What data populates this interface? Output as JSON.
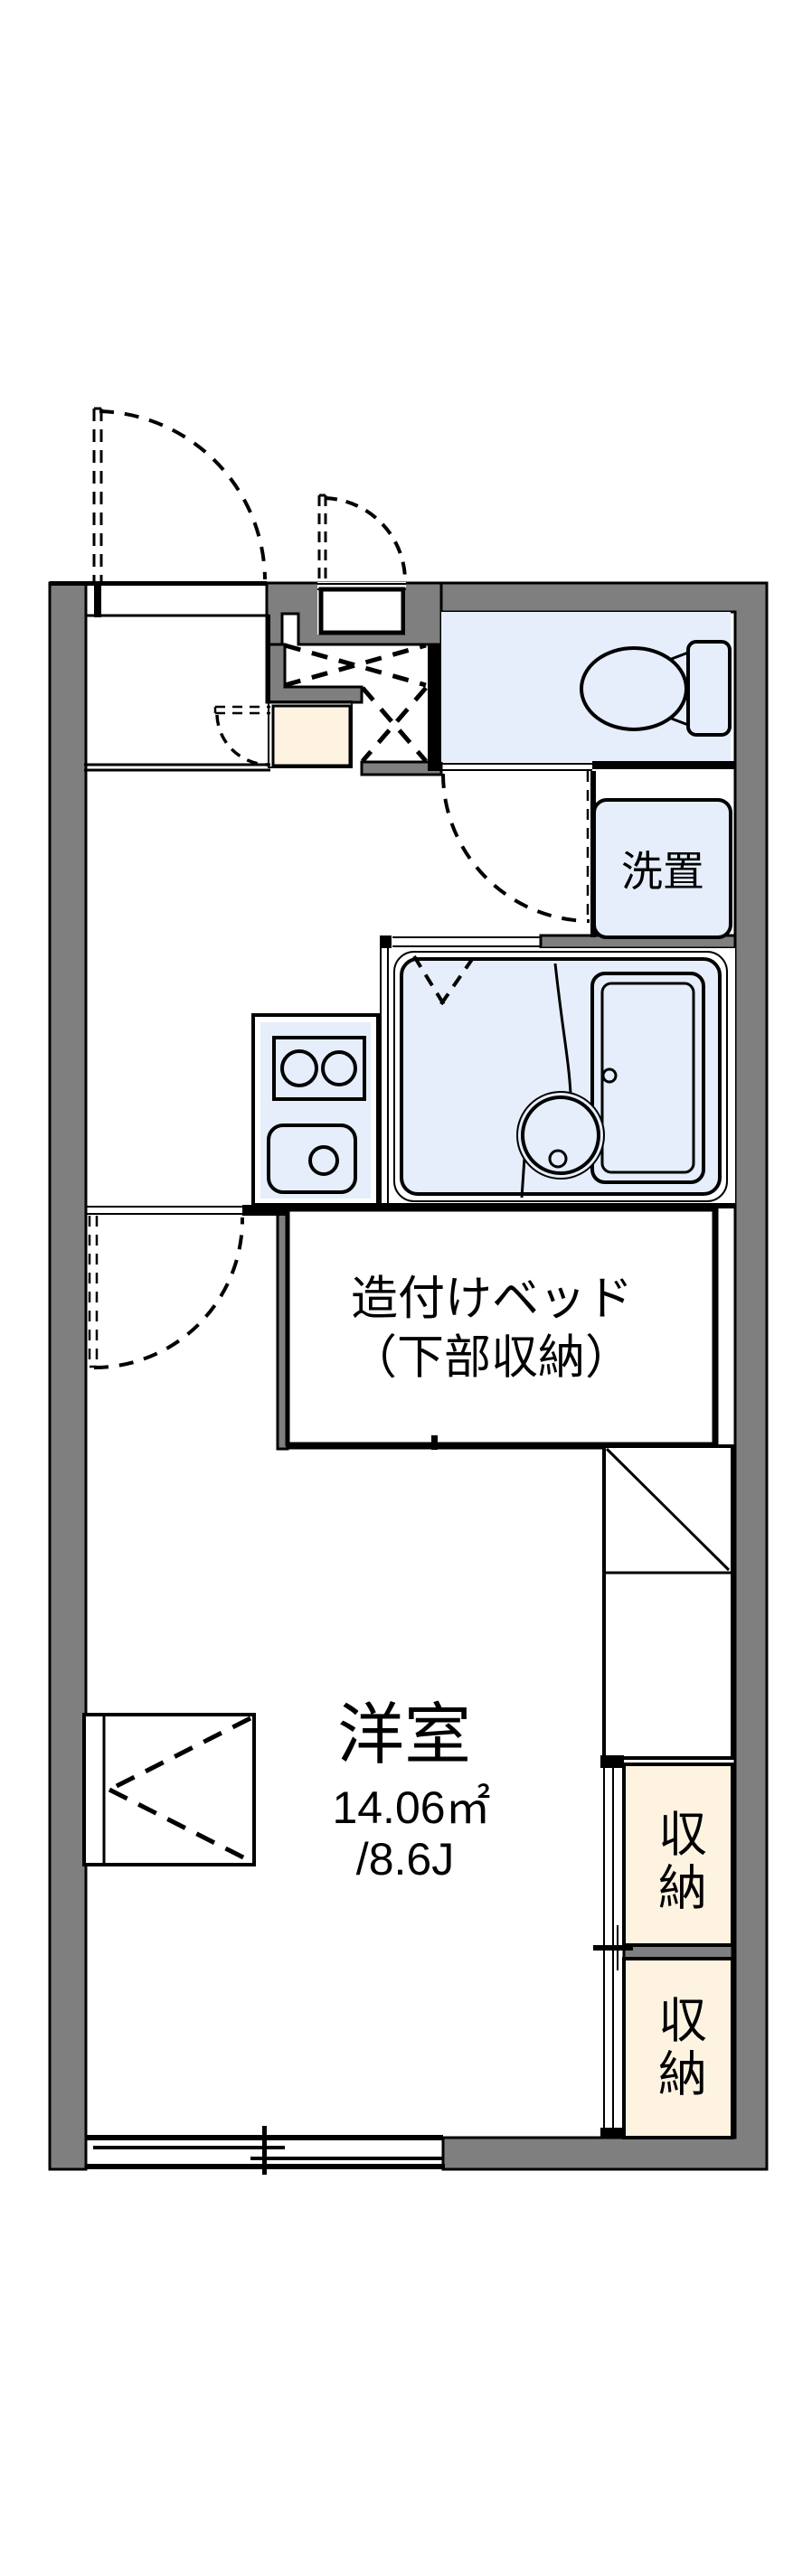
{
  "rooms": {
    "washer_label": "洗置",
    "bed_label_line1": "造付けベッド",
    "bed_label_line2": "（下部収納）",
    "main_room_name": "洋室",
    "main_room_area_sqm": "14.06㎡",
    "main_room_area_tatami": "/8.6J",
    "storage_top_label": "収納",
    "storage_bottom_label": "収納"
  },
  "colors": {
    "wall_gray": "#7f7f7f",
    "wet_area_blue": "#e5eefa",
    "entry_cream": "#fdf3e0",
    "line_black": "#000000",
    "background": "#ffffff"
  }
}
